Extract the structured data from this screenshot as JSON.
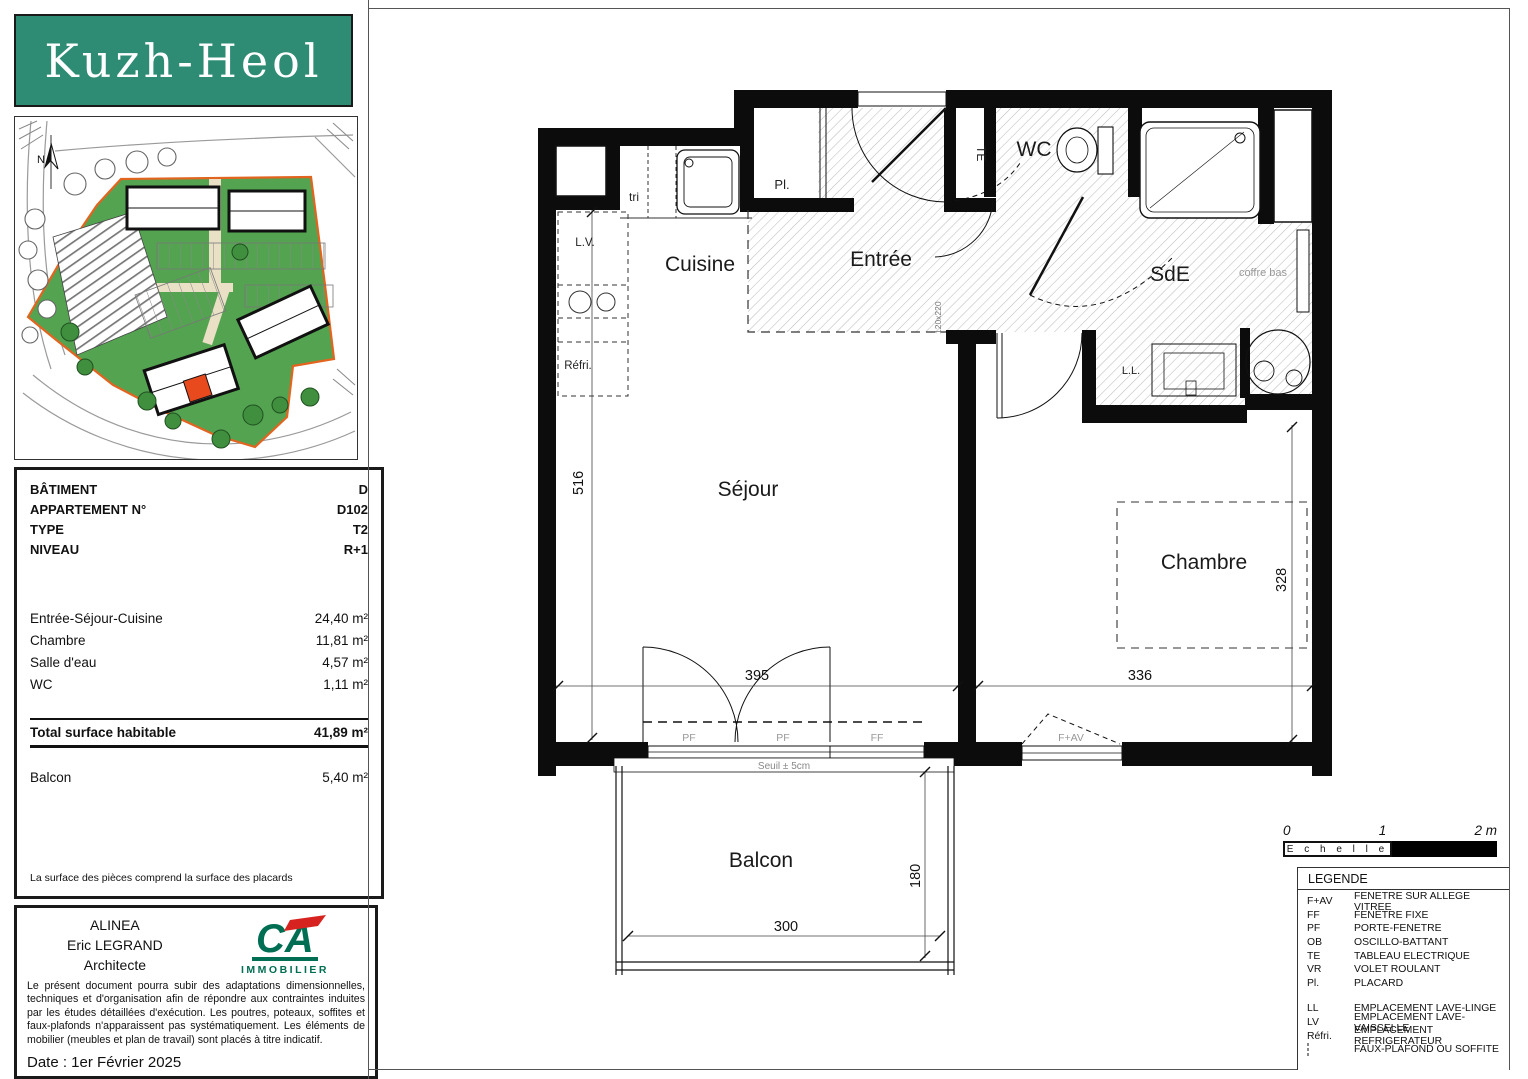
{
  "branding": {
    "logo_text": "Kuzh-Heol"
  },
  "site_plan": {
    "north_label": "N"
  },
  "info_table": {
    "rows": [
      {
        "label": "BÂTIMENT",
        "value": "D"
      },
      {
        "label": "APPARTEMENT N°",
        "value": "D102"
      },
      {
        "label": "TYPE",
        "value": "T2"
      },
      {
        "label": "NIVEAU",
        "value": "R+1"
      }
    ]
  },
  "areas": {
    "rows": [
      {
        "label": "Entrée-Séjour-Cuisine",
        "value": "24,40  m²"
      },
      {
        "label": "Chambre",
        "value": "11,81  m²"
      },
      {
        "label": "Salle d'eau",
        "value": "4,57  m²"
      },
      {
        "label": "WC",
        "value": "1,11  m²"
      }
    ],
    "total": {
      "label": "Total surface habitable",
      "value": "41,89  m²"
    },
    "balcony": {
      "label": "Balcon",
      "value": "5,40  m²"
    },
    "note": "La surface des pièces comprend la surface des placards"
  },
  "architect": {
    "firm": "ALINEA",
    "name": "Eric LEGRAND",
    "title": "Architecte",
    "logo_text": "CA",
    "logo_sub": "IMMOBILIER",
    "disclaimer": "Le présent document pourra subir des adaptations dimensionnelles, techniques et d'organisation afin de répondre aux contraintes induites par les études détaillées d'exécution. Les poutres, poteaux, soffites et faux-plafonds n'apparaissent pas systématiquement. Les éléments de mobilier (meubles et plan de travail) sont placés à titre indicatif.",
    "date": "Date : 1er Février 2025"
  },
  "plan": {
    "rooms": {
      "cuisine": "Cuisine",
      "entree": "Entrée",
      "wc": "WC",
      "sde": "SdE",
      "sejour": "Séjour",
      "chambre": "Chambre",
      "balcon": "Balcon"
    },
    "annotations": {
      "tri": "tri",
      "lv": "L.V.",
      "refri": "Réfri.",
      "pl": "Pl.",
      "te": "TE",
      "ll": "L.L.",
      "coffre_bas": "coffre bas",
      "door_size": "120x220",
      "seuil": "Seuil ± 5cm",
      "pf1": "PF",
      "pf2": "PF",
      "ff": "FF",
      "fav": "F+AV"
    },
    "dimensions": {
      "sejour_height": "516",
      "sejour_width": "395",
      "chambre_width": "336",
      "chambre_height": "328",
      "balcon_width": "300",
      "balcon_depth": "180"
    }
  },
  "scale_bar": {
    "label": "E c h e l l e",
    "ticks": [
      "0",
      "1",
      "2 m"
    ]
  },
  "legend": {
    "title": "LEGENDE",
    "groups": [
      [
        {
          "abbr": "F+AV",
          "label": "FENETRE SUR ALLEGE VITREE"
        },
        {
          "abbr": "FF",
          "label": "FENETRE FIXE"
        },
        {
          "abbr": "PF",
          "label": "PORTE-FENETRE"
        },
        {
          "abbr": "OB",
          "label": "OSCILLO-BATTANT"
        },
        {
          "abbr": "TE",
          "label": "TABLEAU ELECTRIQUE"
        },
        {
          "abbr": "VR",
          "label": "VOLET ROULANT"
        },
        {
          "abbr": "Pl.",
          "label": "PLACARD"
        }
      ],
      [
        {
          "abbr": "LL",
          "label": "EMPLACEMENT LAVE-LINGE"
        },
        {
          "abbr": "LV",
          "label": "EMPLACEMENT LAVE-VAISSELLE"
        },
        {
          "abbr": "Réfri.",
          "label": "EMPLACEMENT REFRIGERATEUR"
        }
      ]
    ],
    "hatch_item": {
      "label": "FAUX-PLAFOND OU SOFFITE"
    }
  },
  "colors": {
    "logo_teal": "#2e8b74",
    "ca_green": "#006e52",
    "ca_red": "#d6231f",
    "site_green": "#54a351",
    "site_boundary_orange": "#e2641f",
    "highlight_unit_red": "#e8491d"
  }
}
